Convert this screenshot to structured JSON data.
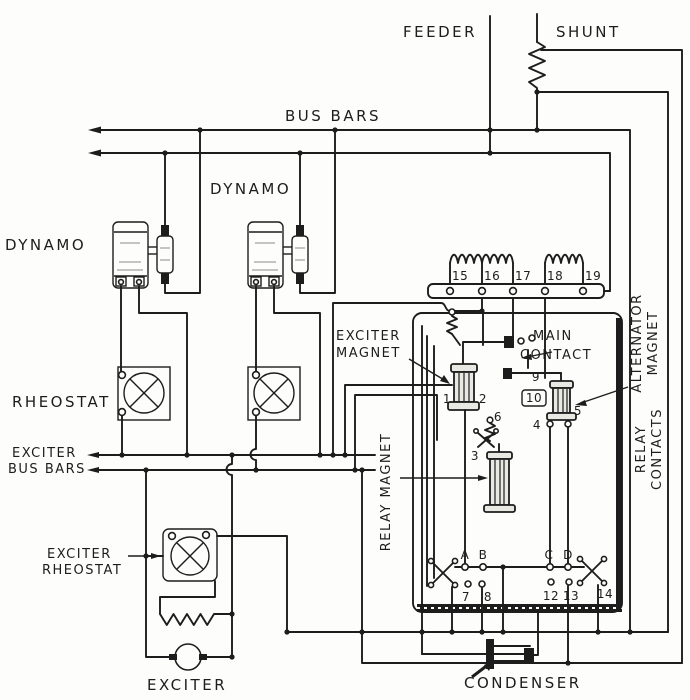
{
  "diagram": {
    "title_hint": "vintage electrical schematic",
    "ink_color": "#1d1d1d",
    "paper_color": "#fdfdfb",
    "labels": {
      "feeder": "FEEDER",
      "shunt": "SHUNT",
      "bus_bars": "BUS BARS",
      "dynamo_left": "DYNAMO",
      "dynamo_right": "DYNAMO",
      "rheostat": "RHEOSTAT",
      "exciter_bus_1": "EXCITER",
      "exciter_bus_2": "BUS BARS",
      "exciter_magnet_1": "EXCITER",
      "exciter_magnet_2": "MAGNET",
      "main_contact_1": "MAIN",
      "main_contact_2": "CONTACT",
      "alternator_magnet_1": "ALTERNATOR",
      "alternator_magnet_2": "MAGNET",
      "relay_magnet": "RELAY MAGNET",
      "relay_contacts_1": "RELAY",
      "relay_contacts_2": "CONTACTS",
      "exciter_rheostat_1": "EXCITER",
      "exciter_rheostat_2": "RHEOSTAT",
      "exciter": "EXCITER",
      "condenser": "CONDENSER"
    },
    "terminals": {
      "t1": "1",
      "t2": "2",
      "t3": "3",
      "t4": "4",
      "t5": "5",
      "t6": "6",
      "t7": "7",
      "t8": "8",
      "t9": "9",
      "t10": "10",
      "t12": "12",
      "t13": "13",
      "t14": "14",
      "t15": "15",
      "t16": "16",
      "t17": "17",
      "t18": "18",
      "t19": "19",
      "a": "A",
      "b": "B",
      "c": "C",
      "d": "D"
    }
  }
}
